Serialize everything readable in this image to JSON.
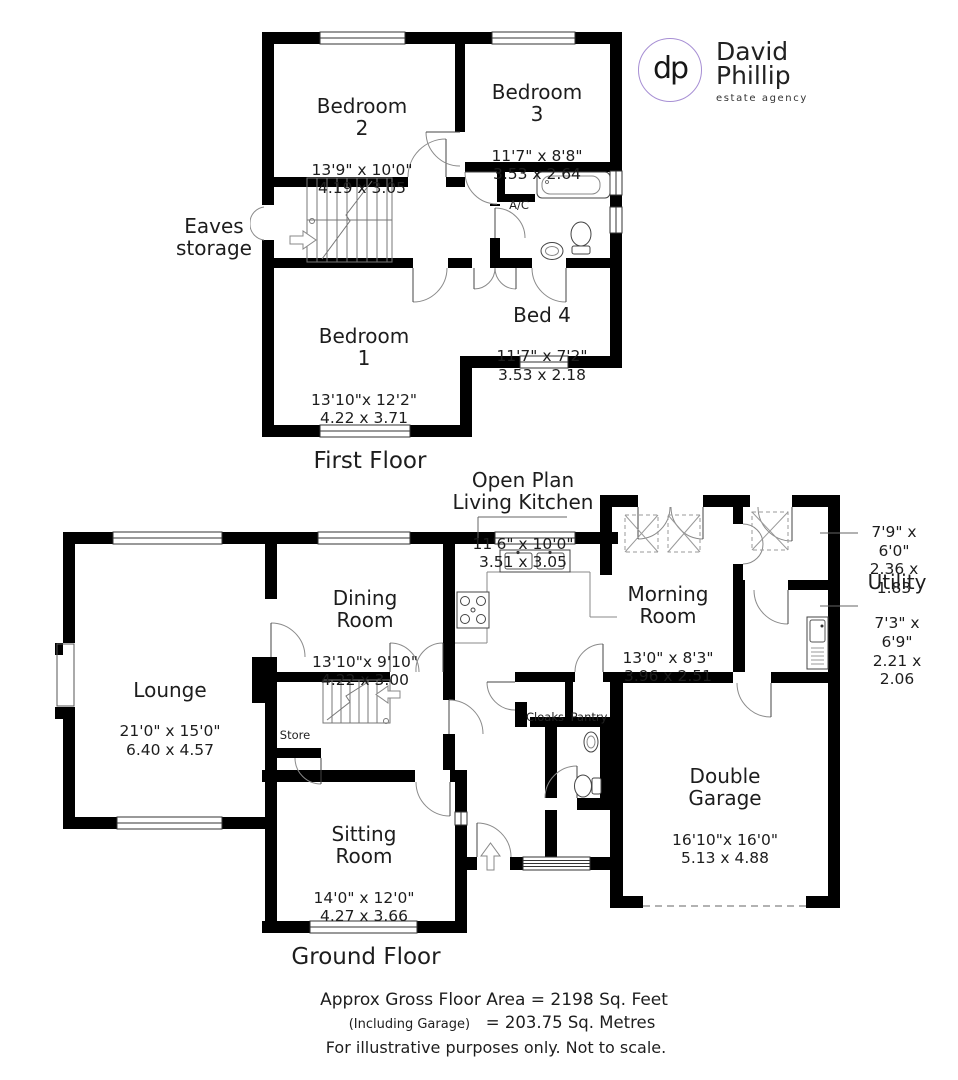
{
  "logo": {
    "initials": "dp",
    "name_line1": "David",
    "name_line2": "Phillip",
    "tagline": "estate agency",
    "circle_color": "#a78fd4"
  },
  "plan_colors": {
    "wall": "#000000",
    "text": "#1d1d1d",
    "door_arc": "#8a8a8a"
  },
  "first_floor": {
    "title": "First Floor",
    "rooms": {
      "bedroom2": {
        "name": "Bedroom\n2",
        "dims": "13'9\" x 10'0\"\n4.19  x  3.05"
      },
      "bedroom3": {
        "name": "Bedroom\n3",
        "dims": "11'7\" x  8'8\"\n3.53  x  2.64"
      },
      "bedroom1": {
        "name": "Bedroom\n1",
        "dims": "13'10\"x 12'2\"\n4.22  x  3.71"
      },
      "bed4": {
        "name": "Bed 4",
        "dims": "11'7\" x  7'2\"\n3.53  x  2.18"
      },
      "eaves": {
        "name": "Eaves\nstorage"
      },
      "ac": {
        "name": "A/C"
      }
    }
  },
  "ground_floor": {
    "title": "Ground Floor",
    "rooms": {
      "kitchen": {
        "name": "Open Plan\nLiving Kitchen",
        "dims": "11'6\" x 10'0\"\n3.51  x  3.05"
      },
      "dining": {
        "name": "Dining\nRoom",
        "dims": "13'10\"x 9'10\"\n4.22  x  3.00"
      },
      "lounge": {
        "name": "Lounge",
        "dims": "21'0\" x 15'0\"\n6.40  x  4.57"
      },
      "morning": {
        "name": "Morning\nRoom",
        "dims": "13'0\" x  8'3\"\n3.96  x  2.51"
      },
      "rear_lobby": {
        "dims": "7'9\"  x  6'0\"\n2.36  x  1.83"
      },
      "utility": {
        "name": "Utility",
        "dims": "7'3\"  x  6'9\"\n2.21  x  2.06"
      },
      "sitting": {
        "name": "Sitting\nRoom",
        "dims": "14'0\" x 12'0\"\n4.27  x  3.66"
      },
      "garage": {
        "name": "Double\nGarage",
        "dims": "16'10\"x 16'0\"\n5.13  x  4.88"
      },
      "store": {
        "name": "Store"
      },
      "cloaks": {
        "name": "Cloaks"
      },
      "pantry": {
        "name": "Pantry"
      }
    }
  },
  "footer": {
    "line1": "Approx Gross Floor Area  =  2198  Sq. Feet",
    "line2_prefix": "(Including Garage)",
    "line2_value": "=  203.75  Sq. Metres",
    "line3": "For illustrative purposes only. Not to scale."
  }
}
